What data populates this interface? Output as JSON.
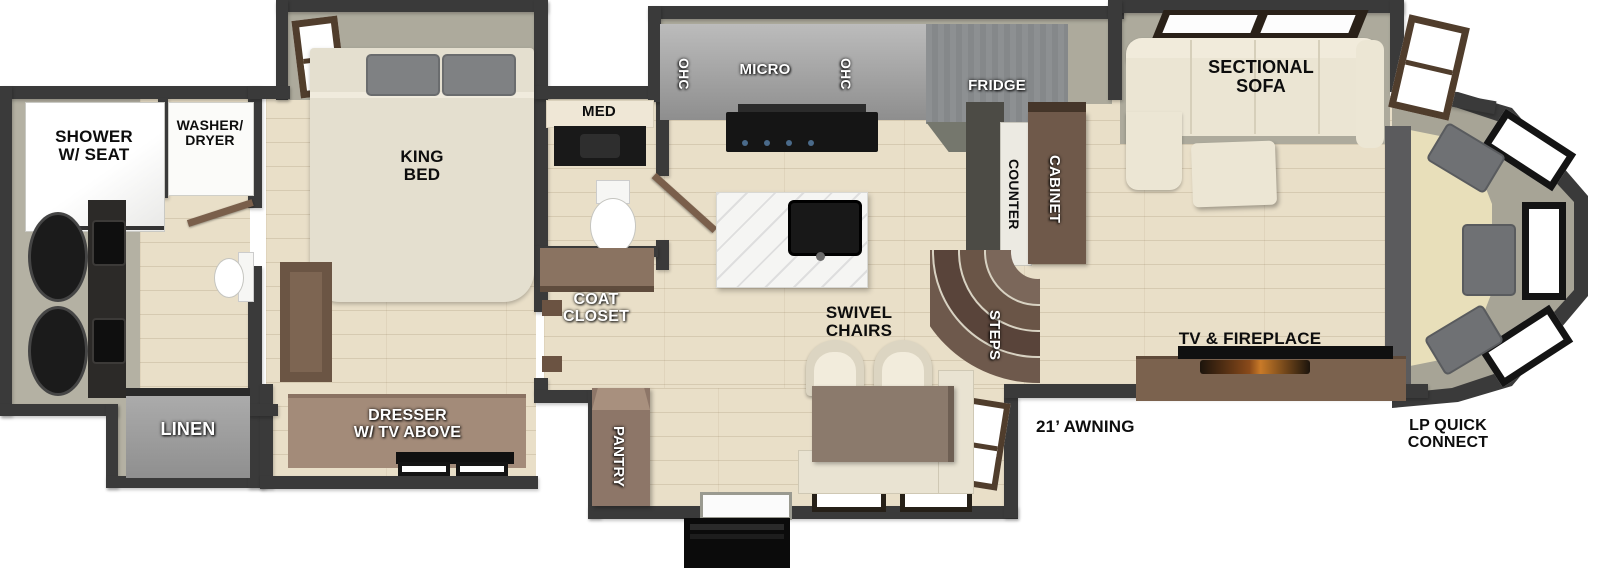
{
  "labels": {
    "bathroom": {
      "shower": "SHOWER\nW/ SEAT",
      "washer_dryer": "WASHER/\nDRYER",
      "linen": "LINEN"
    },
    "bedroom": {
      "king_bed": "KING\nBED",
      "dresser": "DRESSER\nW/ TV ABOVE"
    },
    "half_bath": {
      "med": "MED",
      "coat_closet": "COAT\nCLOSET"
    },
    "kitchen": {
      "ohc_left": "OHC",
      "micro": "MICRO",
      "ohc_right": "OHC",
      "fridge": "FRIDGE",
      "counter": "COUNTER",
      "cabinet": "CABINET",
      "steps": "STEPS",
      "pantry": "PANTRY"
    },
    "living": {
      "swivel_chairs": "SWIVEL\nCHAIRS",
      "sectional_sofa": "SECTIONAL\nSOFA",
      "tv_fireplace": "TV & FIREPLACE"
    },
    "exterior": {
      "awning": "21’ AWNING",
      "lp_quick_connect": "LP QUICK\nCONNECT"
    }
  },
  "colors": {
    "wall": "#3a3a3a",
    "wood_floor": "#e9dfc8",
    "slide_floor": "#adaa9c",
    "cabinetry_gray": "#9d9d9d",
    "furniture_brown": "#6f594a",
    "sofa_cream": "#ece6d4",
    "rear_bench_tan": "#e8dfba",
    "appliance_black": "#141414"
  }
}
